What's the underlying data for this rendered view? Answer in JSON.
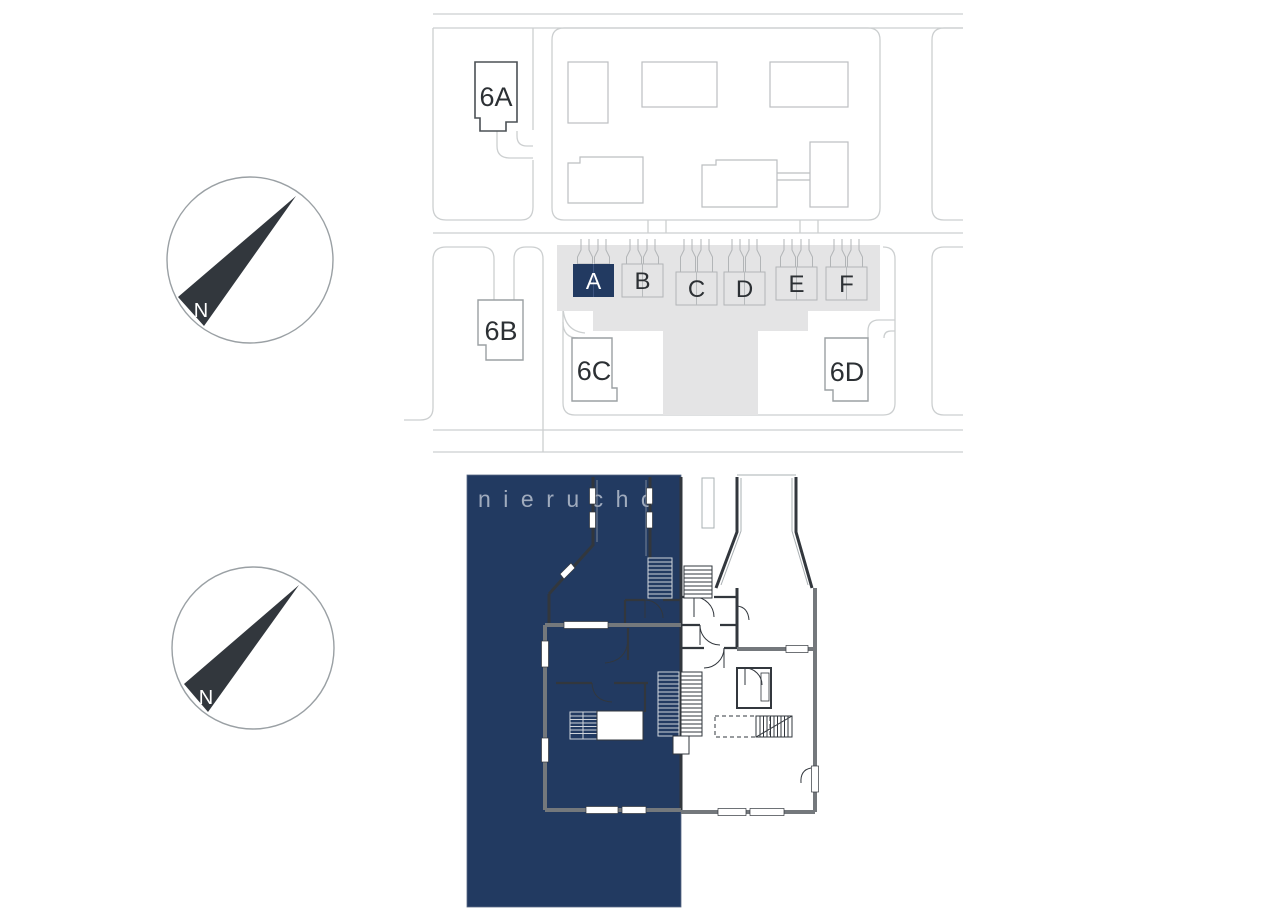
{
  "colors": {
    "highlight": "#223a61",
    "plaza": "#e4e4e5",
    "road": "#cccfd0",
    "wall_dark": "#32373d",
    "wall_gray": "#74787c"
  },
  "compass": {
    "north_label": "N"
  },
  "site_plan": {
    "buildings": [
      {
        "label": "6A"
      },
      {
        "label": "6B"
      },
      {
        "label": "6C"
      },
      {
        "label": "6D"
      }
    ],
    "units": [
      {
        "label": "A",
        "highlighted": true
      },
      {
        "label": "B",
        "highlighted": false
      },
      {
        "label": "C",
        "highlighted": false
      },
      {
        "label": "D",
        "highlighted": false
      },
      {
        "label": "E",
        "highlighted": false
      },
      {
        "label": "F",
        "highlighted": false
      }
    ]
  },
  "floor_plan": {
    "watermark": "nierucho"
  }
}
